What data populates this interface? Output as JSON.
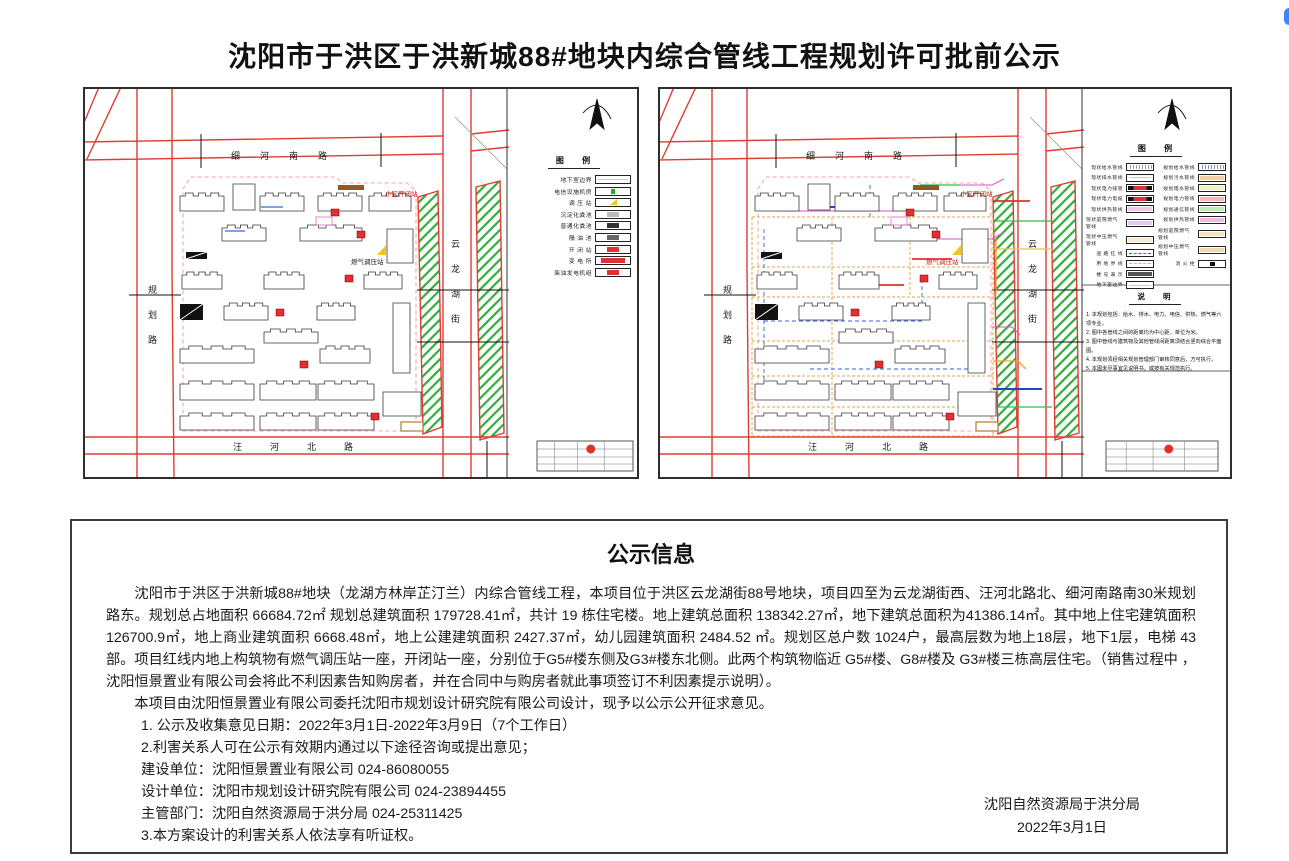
{
  "page": {
    "title": "沈阳市于洪区于洪新城88#地块内综合管线工程规划许可批前公示"
  },
  "maps": {
    "left": {
      "roads": {
        "top": "细河南路",
        "bottom": "汪河北路",
        "left": "规划路",
        "right": "云龙湖街"
      },
      "labels": {
        "switch_station": "小区开闭站",
        "gas_station": "燃气调压站"
      },
      "legend": {
        "title": "图 例",
        "items": [
          {
            "label": "地下室边界",
            "kind": "plain",
            "color": "#cccccc"
          },
          {
            "label": "电信设施机房",
            "kind": "sq",
            "color": "#19b219"
          },
          {
            "label": "调 压 站",
            "kind": "tri",
            "color": "#f5c518"
          },
          {
            "label": "沉淀化粪池",
            "kind": "bar",
            "color": "#bbbbbb"
          },
          {
            "label": "普通化粪池",
            "kind": "bar",
            "color": "#333333"
          },
          {
            "label": "隔 油 池",
            "kind": "bar",
            "color": "#666666"
          },
          {
            "label": "开 闭 站",
            "kind": "bar",
            "color": "#e03030"
          },
          {
            "label": "变 电 所",
            "kind": "wide",
            "color": "#e03030"
          },
          {
            "label": "柴油发电机组",
            "kind": "bar",
            "color": "#e03030"
          }
        ]
      }
    },
    "right": {
      "roads": {
        "top": "细河南路",
        "bottom": "汪河北路",
        "left": "规划路",
        "right": "云龙湖街"
      },
      "labels": {
        "switch_station": "小区开闭站",
        "gas_station": "燃气调压站"
      },
      "legend": {
        "title": "图 例",
        "left_items": [
          {
            "label": "现状给水管线",
            "kind": "hatch",
            "color": "#999999"
          },
          {
            "label": "现状排水管线",
            "kind": "plain",
            "color": "#cccccc"
          },
          {
            "label": "现状电力排管",
            "kind": "rail",
            "color": "#e03030"
          },
          {
            "label": "现状电力电缆",
            "kind": "rail",
            "color": "#e03030"
          },
          {
            "label": "现状供热管线",
            "kind": "fill",
            "color": "#f3c9e4"
          },
          {
            "label": "现状庭院燃气管线",
            "kind": "fill",
            "color": "#e4c9f0"
          },
          {
            "label": "现状中压燃气管线",
            "kind": "fill",
            "color": "#f7ecd8"
          },
          {
            "label": "道 路 红 线",
            "kind": "dash",
            "color": "#e03030"
          },
          {
            "label": "用 地 界 线",
            "kind": "dash",
            "color": "#f2a0a0"
          },
          {
            "label": "楼 号 表 示",
            "kind": "fill",
            "color": "#555555"
          },
          {
            "label": "地下室边界",
            "kind": "plain",
            "color": "#cccccc"
          }
        ],
        "right_items": [
          {
            "label": "规划给水管线",
            "kind": "hatch",
            "color": "#7b8fc9"
          },
          {
            "label": "规划污水管线",
            "kind": "fill",
            "color": "#f6cfa6"
          },
          {
            "label": "规划雨水管线",
            "kind": "fill",
            "color": "#eef2c0"
          },
          {
            "label": "规划电力管线",
            "kind": "fill",
            "color": "#f6b8b8"
          },
          {
            "label": "规划通信管线",
            "kind": "fill",
            "color": "#bdecb6"
          },
          {
            "label": "规划供热管线",
            "kind": "fill",
            "color": "#efb8e6"
          },
          {
            "label": "规划庭院燃气管线",
            "kind": "fill",
            "color": "#f3e3c0"
          },
          {
            "label": "规划中压燃气管线",
            "kind": "fill",
            "color": "#ecd9ae"
          },
          {
            "label": "消 火 栓",
            "kind": "sq",
            "color": "#111111"
          }
        ]
      },
      "notes": {
        "title": "说 明",
        "items": [
          "1. 本规划包括：给水、排水、电力、电信、供热、燃气等六项专业。",
          "2. 图中各管线之间的距离均为中心距，单位为米。",
          "3. 图中管线与建筑物及其他管线间距离须结合竖向综合平面图。",
          "4. 本规划须经相关规划管理部门审核同意后，方可执行。",
          "5. 本图未尽事宜见说明书，或按有关规范执行。"
        ]
      }
    }
  },
  "info": {
    "title": "公示信息",
    "paragraphs": [
      "沈阳市于洪区于洪新城88#地块（龙湖方林岸芷汀兰）内综合管线工程，本项目位于洪区云龙湖街88号地块，项目四至为云龙湖街西、汪河北路北、细河南路南30米规划路东。规划总占地面积 66684.72㎡ 规划总建筑面积 179728.41㎡，共计 19 栋住宅楼。地上建筑总面积 138342.27㎡，地下建筑总面积为41386.14㎡。其中地上住宅建筑面积126700.9㎡，地上商业建筑面积 6668.48㎡，地上公建建筑面积 2427.37㎡，幼儿园建筑面积 2484.52 ㎡。规划区总户数 1024户，最高层数为地上18层，地下1层，电梯 43 部。项目红线内地上构筑物有燃气调压站一座，开闭站一座，分别位于G5#楼东侧及G3#楼东北侧。此两个构筑物临近 G5#楼、G8#楼及 G3#楼三栋高层住宅。（销售过程中 ，沈阳恒景置业有限公司会将此不利因素告知购房者，并在合同中与购房者就此事项签订不利因素提示说明）。",
      "本项目由沈阳恒景置业有限公司委托沈阳市规划设计研究院有限公司设计，现予以公示公开征求意见。"
    ],
    "lines": [
      "1. 公示及收集意见日期：2022年3月1日-2022年3月9日（7个工作日）",
      "2.利害关系人可在公示有效期内通过以下途径咨询或提出意见；",
      "建设单位：沈阳恒景置业有限公司 024-86080055",
      "设计单位：沈阳市规划设计研究院有限公司 024-23894455",
      "主管部门：沈阳自然资源局于洪分局 024-25311425",
      "3.本方案设计的利害关系人依法享有听证权。"
    ],
    "signer": "沈阳自然资源局于洪分局",
    "date": "2022年3月1日"
  }
}
